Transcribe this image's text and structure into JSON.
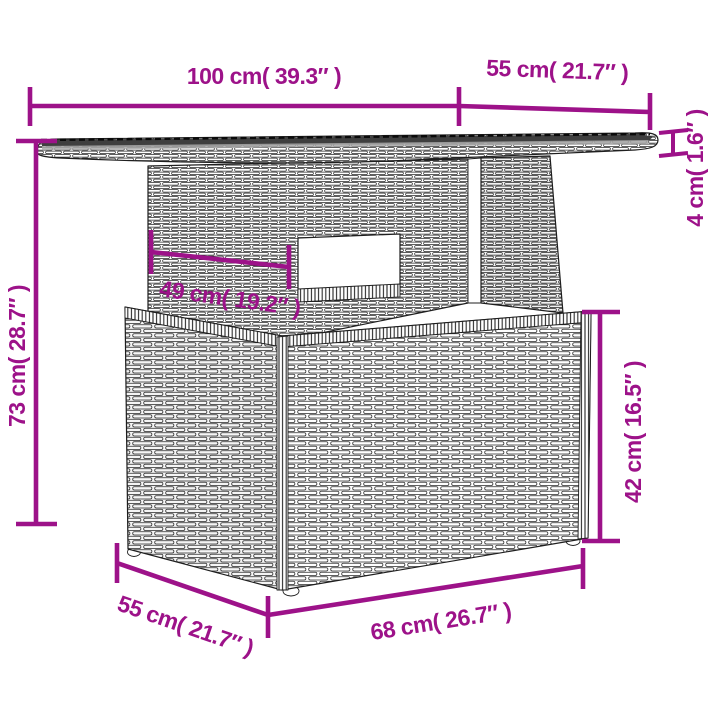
{
  "diagram": {
    "kind": "product-dimension-diagram",
    "product": "poly-rattan-garden-table",
    "colors": {
      "accent": "#9D1289",
      "artwork_line": "#1F1F1F",
      "background": "#FFFFFF"
    },
    "dimensions": [
      {
        "id": "tabletop-length",
        "label": "100 cm( 39.3″ )"
      },
      {
        "id": "tabletop-depth",
        "label": "55 cm( 21.7″ )"
      },
      {
        "id": "tabletop-thickness",
        "label": "4 cm( 1.6″ )"
      },
      {
        "id": "total-height",
        "label": "73 cm( 28.7″ )"
      },
      {
        "id": "pedestal-width",
        "label": "49 cm( 19.2″ )"
      },
      {
        "id": "base-height",
        "label": "42 cm( 16.5″ )"
      },
      {
        "id": "base-depth",
        "label": "55 cm( 21.7″ )"
      },
      {
        "id": "base-width",
        "label": "68 cm( 26.7″ )"
      }
    ]
  }
}
